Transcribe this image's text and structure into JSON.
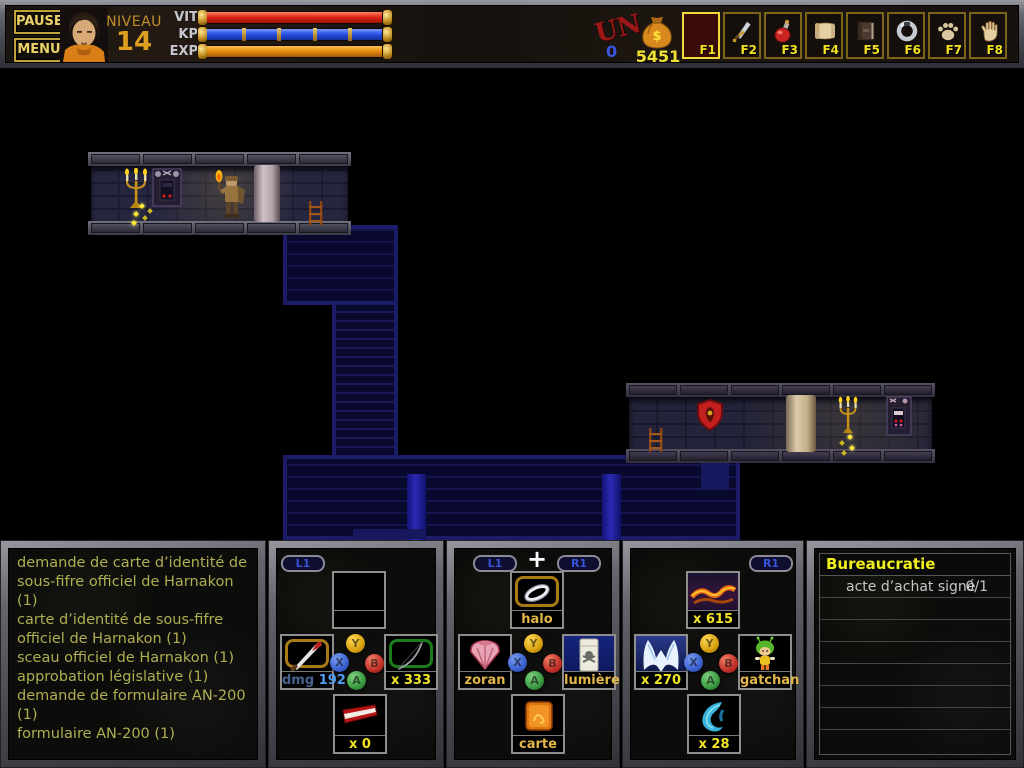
{
  "topbar": {
    "pause_label": "PAUSE",
    "menu_label": "MENU",
    "level_label": "NIVEAU",
    "level_value": "14",
    "stats": [
      {
        "label": "VIT",
        "color": "#e02818",
        "type": "solid"
      },
      {
        "label": "KP",
        "color": "#2a52e8",
        "type": "segmented",
        "segments": 5
      },
      {
        "label": "EXP",
        "color": "#e88c10",
        "type": "solid"
      }
    ],
    "currency_stamp": "UN",
    "currency_stamp_value": "0",
    "gold_amount": "5451",
    "fslots": [
      {
        "key": "F1",
        "icon": "empty-slot",
        "selected": true
      },
      {
        "key": "F2",
        "icon": "sword"
      },
      {
        "key": "F3",
        "icon": "red-potion"
      },
      {
        "key": "F4",
        "icon": "scroll"
      },
      {
        "key": "F5",
        "icon": "book"
      },
      {
        "key": "F6",
        "icon": "silver-ring"
      },
      {
        "key": "F7",
        "icon": "paw-print"
      },
      {
        "key": "F8",
        "icon": "open-hand"
      }
    ]
  },
  "gamepad": {
    "top": "Y",
    "left": "X",
    "right": "B",
    "bottom": "A"
  },
  "inventory_list": {
    "items": [
      "demande de carte d’identité de sous-fifre officiel de Harnakon (1)",
      "carte d’identité de sous-fifre officiel de Harnakon (1)",
      "sceau officiel de Harnakon (1)",
      "approbation législative (1)",
      "demande de formulaire AN-200  (1)",
      "formulaire AN-200  (1)"
    ]
  },
  "weapon_panel": {
    "shoulder_badge": "L1",
    "slots": {
      "top": {
        "icon": "empty",
        "label": ""
      },
      "left": {
        "icon": "bloody-knife",
        "dmg_label": "dmg",
        "dmg_value": "192"
      },
      "right": {
        "icon": "bow",
        "label": "x 333"
      },
      "bottom": {
        "icon": "red-bolt",
        "label": "x 0"
      }
    }
  },
  "item_panel": {
    "badge_left": "L1",
    "badge_right": "R1",
    "plus": "+",
    "slots": {
      "top": {
        "icon": "halo-ring",
        "label": "halo"
      },
      "left": {
        "icon": "seashell",
        "label": "zoran"
      },
      "right": {
        "icon": "lighter-skull",
        "label": "lumière"
      },
      "bottom": {
        "icon": "map-card",
        "label": "carte"
      }
    }
  },
  "spell_panel": {
    "shoulder_badge": "R1",
    "slots": {
      "top": {
        "icon": "fire-wave",
        "label": "x 615"
      },
      "left": {
        "icon": "ice-crystal",
        "label": "x 270"
      },
      "right": {
        "icon": "gatchan-sprite",
        "label": "gatchan"
      },
      "bottom": {
        "icon": "blue-flame",
        "label": "x 28"
      }
    }
  },
  "quest_panel": {
    "title": "Bureaucratie",
    "entries": [
      {
        "text": "acte d’achat signé",
        "progress": "0/1"
      }
    ]
  }
}
